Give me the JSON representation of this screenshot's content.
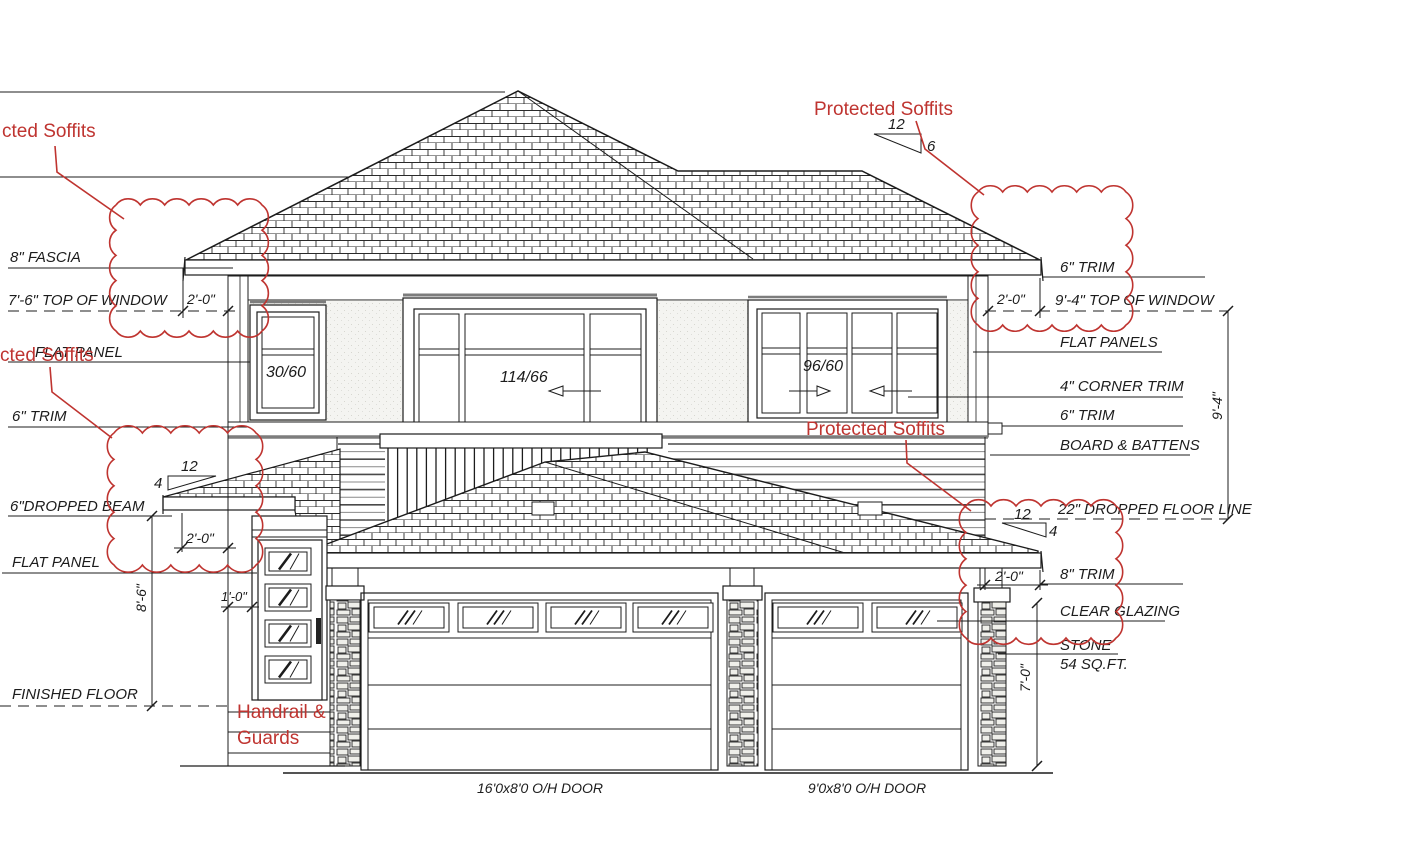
{
  "drawing": {
    "kind": "residential front elevation blueprint",
    "colors": {
      "annotation_red": "#bf3430",
      "line": "#1c1c1c"
    },
    "left_labels": {
      "fascia": "8\" FASCIA",
      "top_of_window": "7'-6\" TOP OF WINDOW",
      "flat_panel_upper": "FLAT PANEL",
      "trim_6": "6\" TRIM",
      "dropped_beam": "6\"DROPPED BEAM",
      "flat_panel_lower": "FLAT PANEL",
      "finished_floor": "FINISHED FLOOR"
    },
    "right_labels": {
      "trim_6_top": "6\" TRIM",
      "top_of_window": "9'-4\" TOP OF WINDOW",
      "flat_panels": "FLAT PANELS",
      "corner_trim": "4\" CORNER TRIM",
      "trim_6": "6\" TRIM",
      "board_battens": "BOARD & BATTENS",
      "dropped_floor_line": "22\" DROPPED FLOOR LINE",
      "trim_8": "8\" TRIM",
      "clear_glazing": "CLEAR GLAZING",
      "stone": "STONE",
      "stone_area": "54 SQ.FT."
    },
    "dimensions": {
      "eave": "2'-0\"",
      "entry_jog": "1'-0\"",
      "entry_height": "8'-6\"",
      "garage_opening": "7'-0\"",
      "upper_window": "9'-4\""
    },
    "slopes": {
      "run": "12",
      "rise_upper": "6",
      "rise_lower": "4"
    },
    "windows": {
      "left": "30/60",
      "center": "114/66",
      "right": "96/60"
    },
    "garage_doors": {
      "large": "16'0x8'0 O/H DOOR",
      "small": "9'0x8'0 O/H DOOR"
    },
    "red_notes": {
      "protected_soffits": "Protected Soffits",
      "protected_soffits_clipped": "cted Soffits",
      "handrail_line1": "Handrail &",
      "handrail_line2": "Guards"
    }
  }
}
